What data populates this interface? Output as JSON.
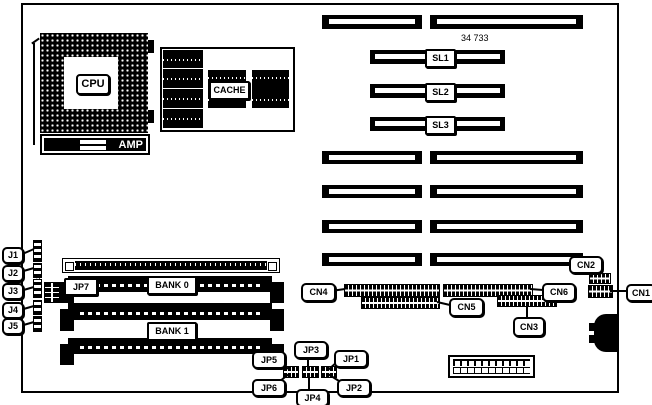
{
  "board": {
    "part_number": "34 733",
    "cpu": {
      "label": "CPU",
      "regulator_label": "AMP"
    },
    "cache": {
      "label": "CACHE"
    },
    "expansion_slots": {
      "sl1": "SL1",
      "sl2": "SL2",
      "sl3": "SL3"
    },
    "memory_banks": {
      "bank0": "BANK 0",
      "bank1": "BANK 1"
    },
    "jumpers": {
      "jp1": "JP1",
      "jp2": "JP2",
      "jp3": "JP3",
      "jp4": "JP4",
      "jp5": "JP5",
      "jp6": "JP6",
      "jp7": "JP7",
      "jp7_pin3": "3",
      "jp7_pin4": "4"
    },
    "connectors": {
      "cn1": "CN1",
      "cn2": "CN2",
      "cn3": "CN3",
      "cn4": "CN4",
      "cn5": "CN5",
      "cn6": "CN6",
      "j1": "J1",
      "j2": "J2",
      "j3": "J3",
      "j4": "J4",
      "j5": "J5"
    },
    "colors": {
      "line": "#000000",
      "background": "#ffffff"
    }
  }
}
